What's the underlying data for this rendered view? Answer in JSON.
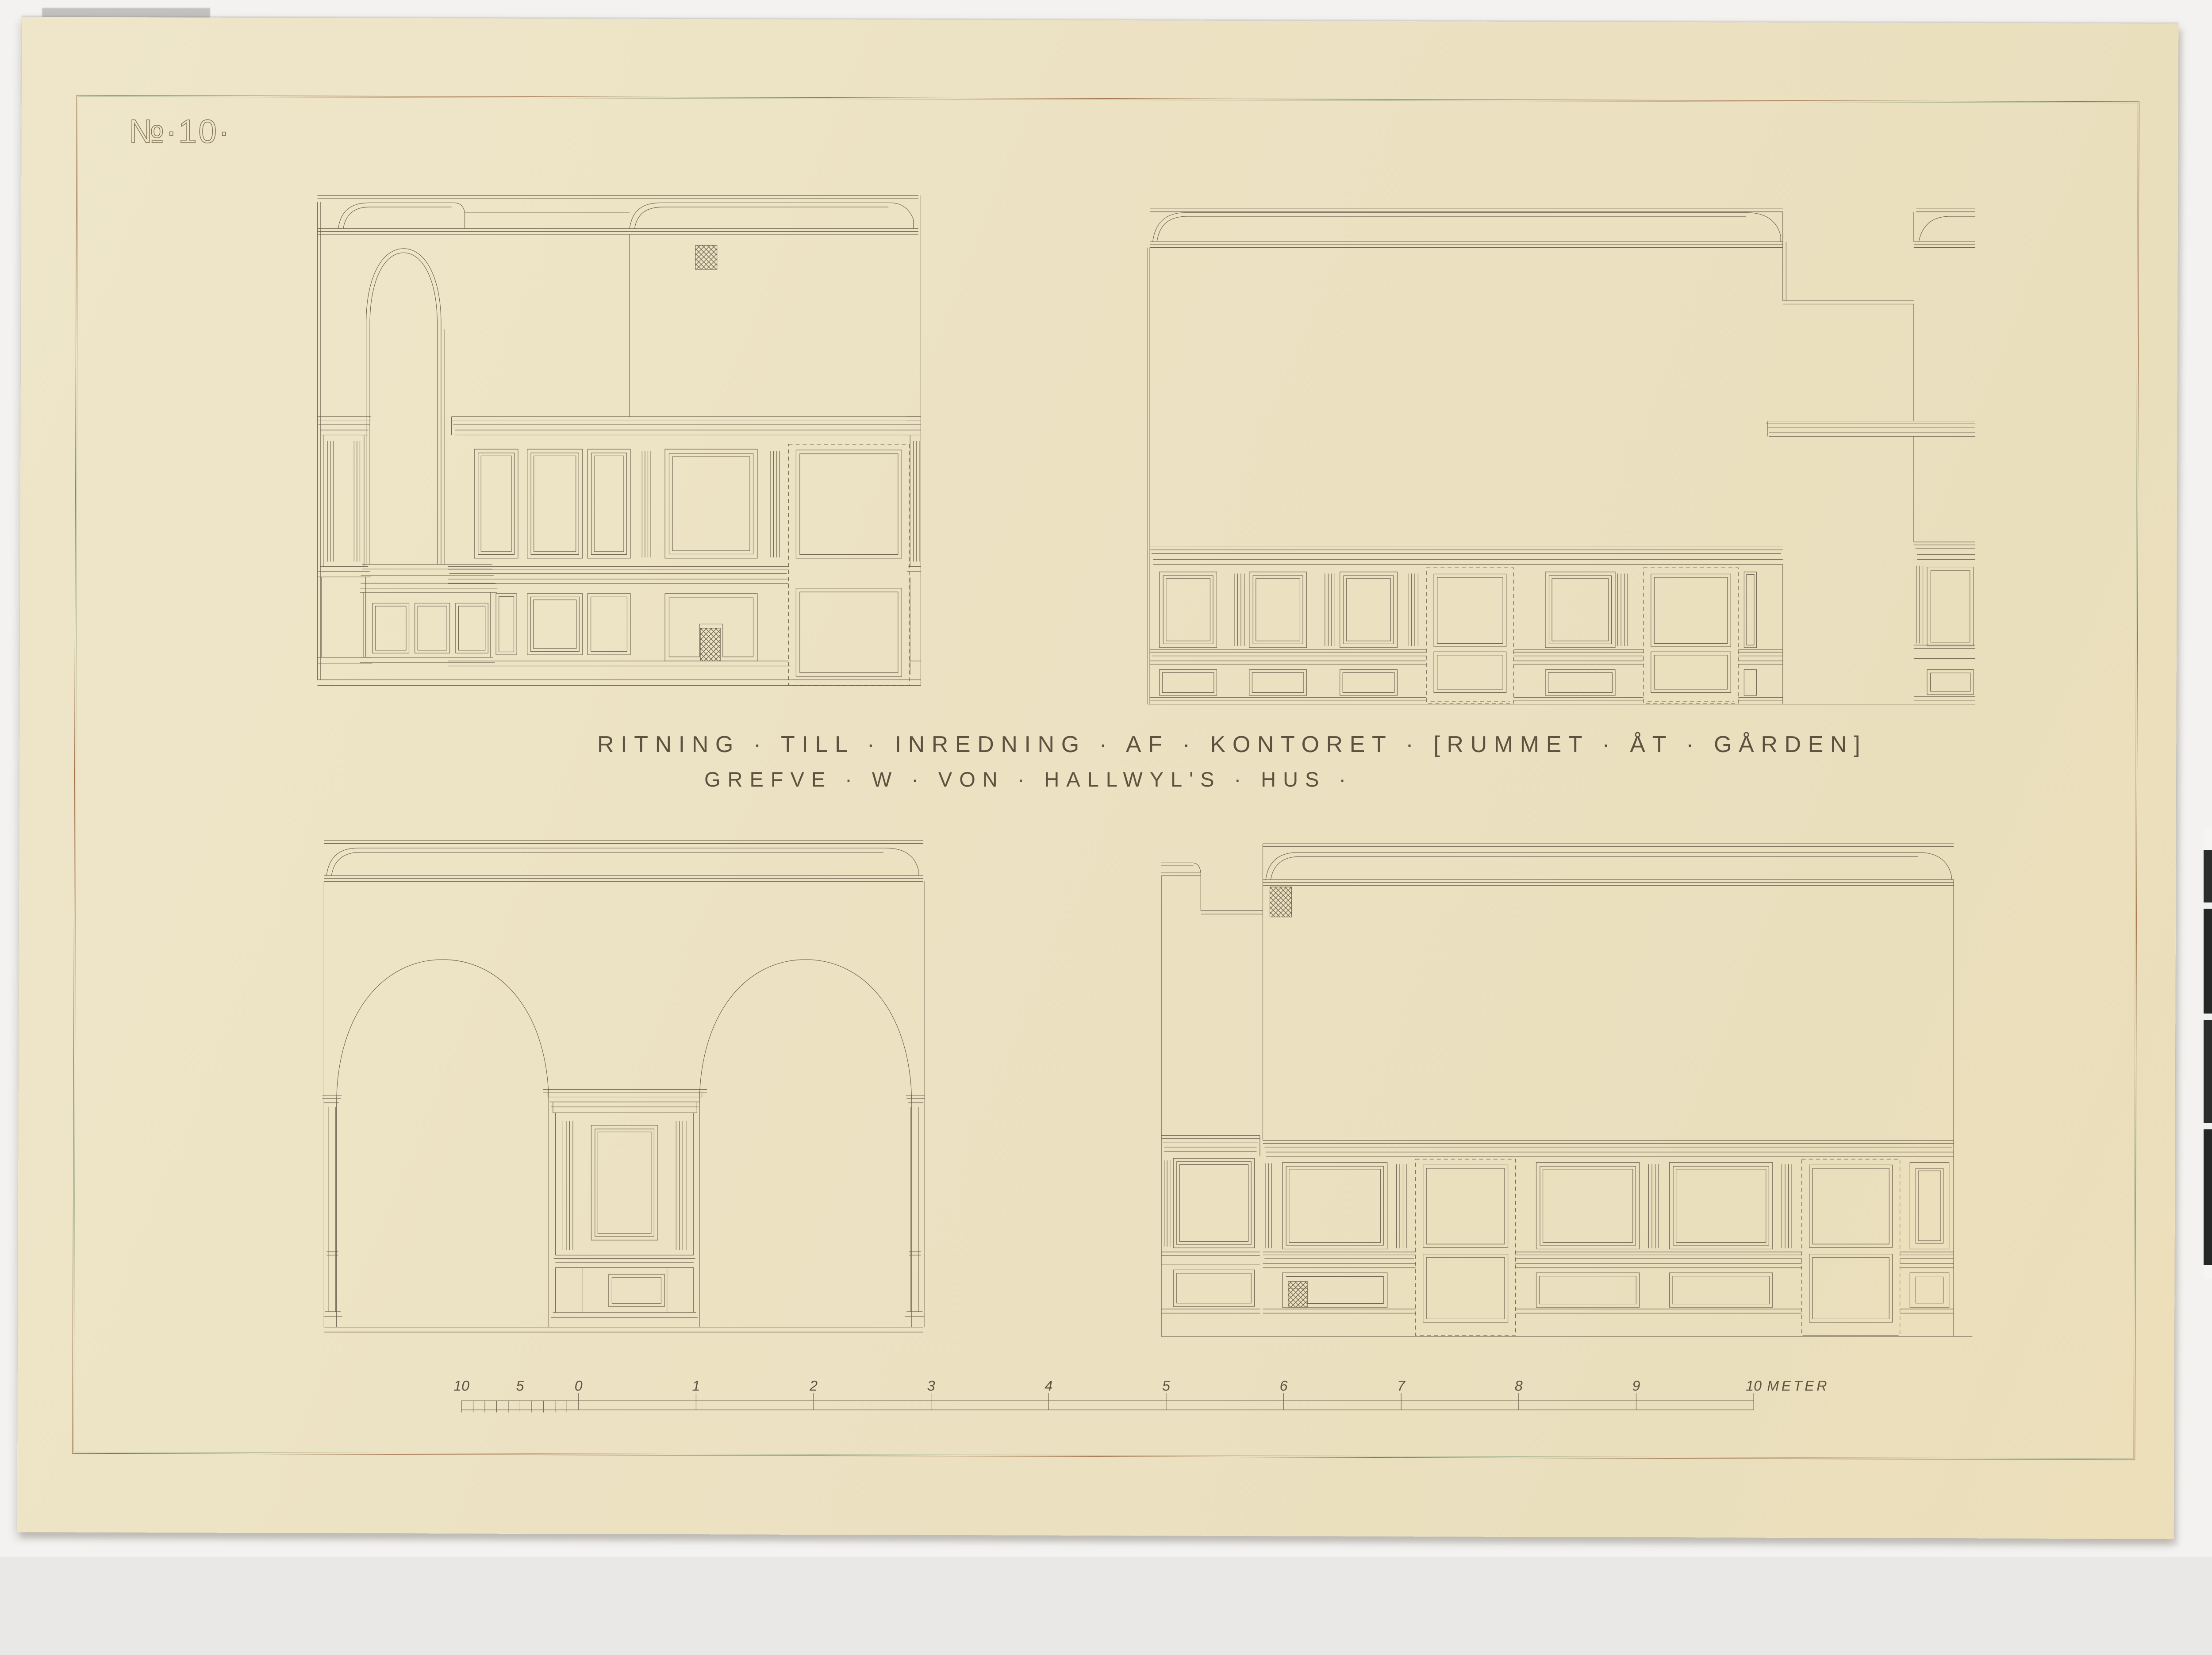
{
  "page": {
    "background_color": "#f3f2f0",
    "paper_color": "#ece2c3",
    "ink_color": "#6e6250",
    "text_ink_color": "#5d5140",
    "frame_outer_color": "#98663f",
    "frame_inner_color": "#a9b896",
    "photo_strip_dark_color": "#242726"
  },
  "sheet": {
    "number_label": "№·10·"
  },
  "title": {
    "line1": "RITNING · TILL · INREDNING · AF · KONTORET · [RUMMET · ÅT · GÅRDEN]",
    "line2": "GREFVE · W · VON · HALLWYL'S · HUS ·"
  },
  "scale_bar": {
    "tick_labels": [
      "10",
      "5",
      "0",
      "1",
      "2",
      "3",
      "4",
      "5",
      "6",
      "7",
      "8",
      "9",
      "10"
    ],
    "unit_label": "METER"
  }
}
